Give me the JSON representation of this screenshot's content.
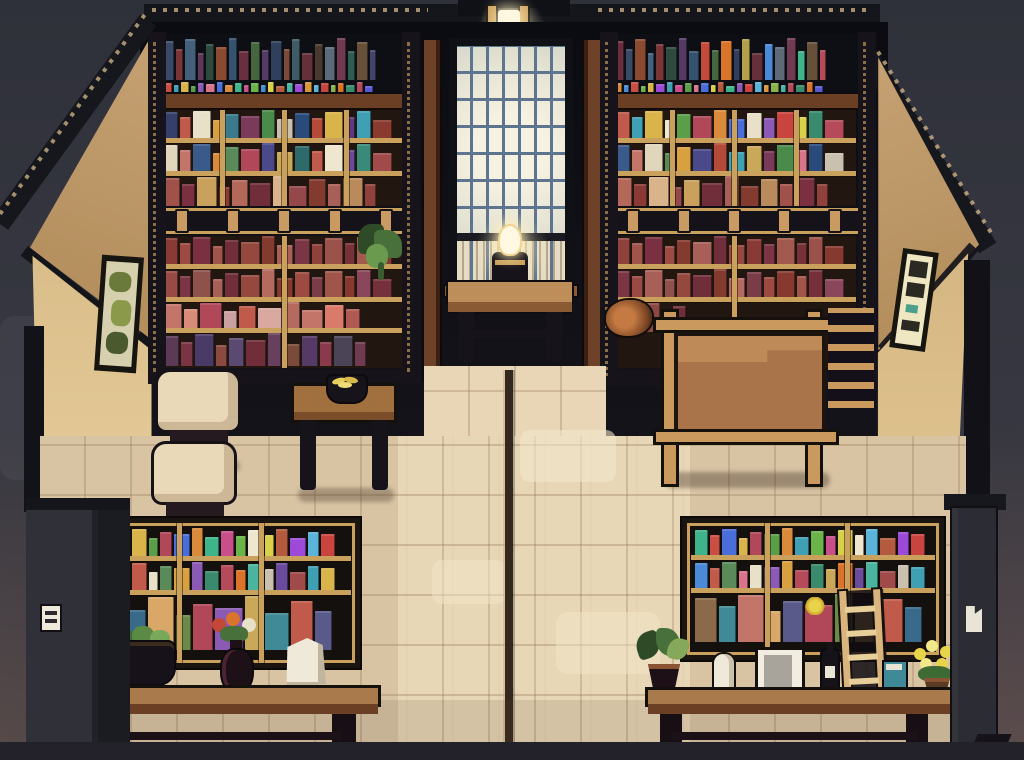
{
  "scene": {
    "name": "pixel-art-library-interior",
    "style": "16-bit cutaway room, night lighting",
    "palette": {
      "bg_top": "#2f313a",
      "bg_mid": "#3a3b45",
      "back_wall": "#0b0c11",
      "roof": "#15161c",
      "wall_upper": "#c2a070",
      "wall_lower": "#e0c48f",
      "shelf_dark": "#17131a",
      "shelf_wood": "#6a3f24",
      "shelf_gold": "#c9a05c",
      "shelf_interior": "#221710",
      "window_frame": "#101117",
      "window_glass": "#ece9da",
      "window_glass_low": "#e6dcc4",
      "window_mullion": "#5d7590",
      "lantern_glow": "#fff7df",
      "lamp_flame": "#fff8e2",
      "table_wood": "#bd8d5a",
      "table_side": "#8a5a34",
      "board_panel": "#a9744a",
      "board_panel_light": "#bd8a58",
      "board_frame": "#c9995e",
      "floor": "#d8c4a3",
      "floor_aisle": "#e8d6b6",
      "floor_seam": "#33281e",
      "counter_top": "#a97a4c",
      "counter_front": "#6a3f24",
      "stool_seat": "#ead9b8",
      "pillar_left": "#303138",
      "pillar_right": "#2c2d34",
      "poster_bg": "#efe6c2",
      "picture_canvas": "#d6d0ae",
      "plant_green": "#47703a",
      "flower_red": "#c4483a",
      "flower_yellow": "#e8d44a",
      "bag_white": "#efe9da",
      "bottom_band": "#232129"
    }
  },
  "objects": {
    "window": "tall paned window, warm glow",
    "lantern": "roof lantern above window",
    "lamp": "table lamp with lit flame",
    "board": "blank wooden notice board",
    "stools": "two cream upholstered stools",
    "fruit_table": "side table with fruit bowl",
    "left_counter": "display counter: basket, flower vase, paper bag",
    "right_counter": "display counter: plant, figurine, card, bottle, book, flowers, ladder",
    "pillars": "dark gray corner pillars with small white tags"
  },
  "shelves": {
    "left": {
      "top_spines": [
        "#3a4a66",
        "#7a3536",
        "#44607a",
        "#5c3a56",
        "#2e4a3e",
        "#8a4a30",
        "#35526e",
        "#6a2f3f",
        "#46663f",
        "#553a66",
        "#2f3f5c",
        "#7a4a3a",
        "#3f5c66",
        "#66303a",
        "#4a3a2e",
        "#5c6a7a",
        "#703a50",
        "#2e5c50",
        "#66503a",
        "#44456a"
      ],
      "color_strip": [
        "#c94f43",
        "#3fa0b4",
        "#d9b44a",
        "#5a9e4a",
        "#8a5ab4",
        "#d9748a",
        "#4a6ed9",
        "#d98a3a",
        "#3fb48a",
        "#c94f8a",
        "#6ab44a",
        "#4a8ad9",
        "#d9d04a",
        "#b45a3f",
        "#4ab4a0",
        "#9e4ad9",
        "#d9963a",
        "#5ab4d9",
        "#c9443f",
        "#8ab44a",
        "#d9742a",
        "#3a8a6e",
        "#b44a5a",
        "#5a5ad9"
      ],
      "u1": [
        "#35406a",
        "#c05a4a",
        "#e8e0c8",
        "#d9a040",
        "#3a7a8a",
        "#7a3a5a",
        "#4a8a4a",
        "#c9c0b0",
        "#2a4a7a",
        "#b44a3a",
        "#d9b44a",
        "#5a3a7a",
        "#3fa0b4",
        "#8a3a2e"
      ],
      "u2": [
        "#e0d6bc",
        "#c4756a",
        "#3a5a8a",
        "#d98a3a",
        "#5a8a5a",
        "#b0485a",
        "#4a4a8a",
        "#caa85a",
        "#2e6a6a",
        "#c05a4a",
        "#efe6d0",
        "#6a4a9a",
        "#3a8a7a",
        "#a04a4a"
      ],
      "u3": [
        "#a0524a",
        "#7a3040",
        "#c9a05c",
        "#8a3a34",
        "#b4685a",
        "#6f2e3a",
        "#d9b48a",
        "#94484a",
        "#833b30",
        "#a85f57",
        "#b98a5c",
        "#8f413b"
      ],
      "l1": [
        "#8a3a34",
        "#9c4a42",
        "#7a3040",
        "#a0544a",
        "#6f2e3a",
        "#94483e",
        "#833b30",
        "#a85f57",
        "#7c3544",
        "#8f413b",
        "#9a524a",
        "#763236",
        "#a25a4e",
        "#88392f"
      ],
      "l2": [
        "#9a4a44",
        "#7c3544",
        "#8f514b",
        "#a85f57",
        "#6f2e3a",
        "#94483e",
        "#b46a5e",
        "#833b30",
        "#9c4a42",
        "#7a3c46",
        "#a0544a",
        "#88392f",
        "#8a465a",
        "#75303c"
      ],
      "l3": [
        "#c4756a",
        "#d98a7a",
        "#b0485a",
        "#caa0a0",
        "#c05a4a",
        "#d9a8a0",
        "#b46a5e",
        "#c4756a",
        "#d97a6a",
        "#b05a52"
      ],
      "l4": [
        "#5c3a56",
        "#7a3545",
        "#4a3a66",
        "#8a4a42",
        "#5a4a72",
        "#6f2e3a",
        "#66405c",
        "#7a4a3a",
        "#553a66",
        "#8a3a4a",
        "#4a4456",
        "#703a50"
      ]
    },
    "right": {
      "top_spines": [
        "#6a2f3f",
        "#3a4a66",
        "#8a4a30",
        "#44607a",
        "#7a3536",
        "#2e4a3e",
        "#553a66",
        "#35526e",
        "#c44a3a",
        "#46663f",
        "#d9742a",
        "#2f3f5c",
        "#b4a04a",
        "#66303a",
        "#4a8ad9",
        "#5c6a7a",
        "#703a50",
        "#3fb48a",
        "#66503a",
        "#b44a5a"
      ],
      "color_strip": [
        "#d98a3a",
        "#4a8ad9",
        "#c94f43",
        "#6ab44a",
        "#d9b44a",
        "#9e4ad9",
        "#3fa0b4",
        "#c94f8a",
        "#5a9e4a",
        "#d9748a",
        "#4a6ed9",
        "#d9d04a",
        "#b45a3f",
        "#3fb48a",
        "#8a5ab4",
        "#c9443f",
        "#5ab4d9",
        "#d9963a",
        "#8ab44a",
        "#4ab4a0",
        "#b44a5a",
        "#3a8a6e",
        "#d9742a",
        "#5a5ad9"
      ],
      "u1": [
        "#c05a4a",
        "#3fa0b4",
        "#d9b44a",
        "#efe6d0",
        "#5a9e4a",
        "#b0485a",
        "#d98a3a",
        "#4a6ed9",
        "#e8e0c8",
        "#8a5ab4",
        "#c9443f",
        "#d9d04a",
        "#3a8a6e",
        "#b44a5a"
      ],
      "u2": [
        "#3a5a8a",
        "#c4756a",
        "#e0d6bc",
        "#5a8a5a",
        "#d9a040",
        "#4a4a8a",
        "#b44a3a",
        "#3fa0b4",
        "#caa85a",
        "#7a3a5a",
        "#4a8a4a",
        "#d9748a",
        "#2a4a7a",
        "#c9c0b0"
      ],
      "u3": [
        "#b4685a",
        "#8a3a34",
        "#d9b48a",
        "#94484a",
        "#c9a05c",
        "#6f2e3a",
        "#a85f57",
        "#833b30",
        "#b98a5c",
        "#a0524a",
        "#7a3040",
        "#8f413b"
      ],
      "l1": [
        "#8f413b",
        "#a0544a",
        "#7a3040",
        "#9c4a42",
        "#833b30",
        "#a85f57",
        "#6f2e3a",
        "#94483e",
        "#8a3a34",
        "#7c3544",
        "#a25a4e",
        "#763236",
        "#9a524a",
        "#88392f"
      ],
      "l2": [
        "#7c3544",
        "#9a4a44",
        "#a85f57",
        "#8f514b",
        "#94483e",
        "#6f2e3a",
        "#833b30",
        "#b46a5e",
        "#7a3c46",
        "#9c4a42",
        "#88392f",
        "#a0544a",
        "#75303c",
        "#8a465a"
      ],
      "bottom_left": [
        "#7a3545",
        "#5c3a56",
        "#8a4a42",
        "#4a3a66",
        "#6f2e3a"
      ]
    },
    "cabinet_left": {
      "r1": [
        "#c94f43",
        "#3fa0b4",
        "#d9b44a",
        "#5a9e4a",
        "#b0485a",
        "#4a6ed9",
        "#d98a3a",
        "#3fb48a",
        "#c94f8a",
        "#6ab44a",
        "#efe6d0",
        "#d9d04a",
        "#b45a3f",
        "#9e4ad9",
        "#5ab4d9",
        "#c9443f"
      ],
      "r2": [
        "#d9748a",
        "#4a8ad9",
        "#c05a4a",
        "#e8e0c8",
        "#5a8a5a",
        "#d9a040",
        "#8a5ab4",
        "#3a8a6e",
        "#b44a5a",
        "#d9742a",
        "#4ab4a0",
        "#c9c0b0",
        "#6a4a9a",
        "#a04a4a",
        "#3fa0b4",
        "#d9b44a"
      ],
      "r3": [
        "#c4756a",
        "#3a6a8a",
        "#d9a868",
        "#6a8a4a",
        "#b0485a",
        "#8a5ab4",
        "#caa85a",
        "#3f8a96",
        "#c05a4a",
        "#5a5a8a"
      ]
    },
    "cabinet_right": {
      "r1": [
        "#3fb48a",
        "#c94f43",
        "#4a6ed9",
        "#d9b44a",
        "#b0485a",
        "#5a9e4a",
        "#d98a3a",
        "#3fa0b4",
        "#6ab44a",
        "#c94f8a",
        "#d9d04a",
        "#efe6d0",
        "#5ab4d9",
        "#b45a3f",
        "#9e4ad9",
        "#c9443f"
      ],
      "r2": [
        "#4a8ad9",
        "#c05a4a",
        "#5a8a5a",
        "#d9748a",
        "#e8e0c8",
        "#8a5ab4",
        "#d9a040",
        "#b44a5a",
        "#3a8a6e",
        "#caa85a",
        "#d9742a",
        "#6a4a9a",
        "#4ab4a0",
        "#a04a4a",
        "#c9c0b0",
        "#3fa0b4"
      ],
      "r3": [
        "#8a6a4a",
        "#3f8a96",
        "#c4756a",
        "#d9a868",
        "#5a5a8a",
        "#b0485a",
        "#6a8a4a",
        "#caa85a",
        "#c05a4a",
        "#3a6a8a"
      ]
    }
  }
}
